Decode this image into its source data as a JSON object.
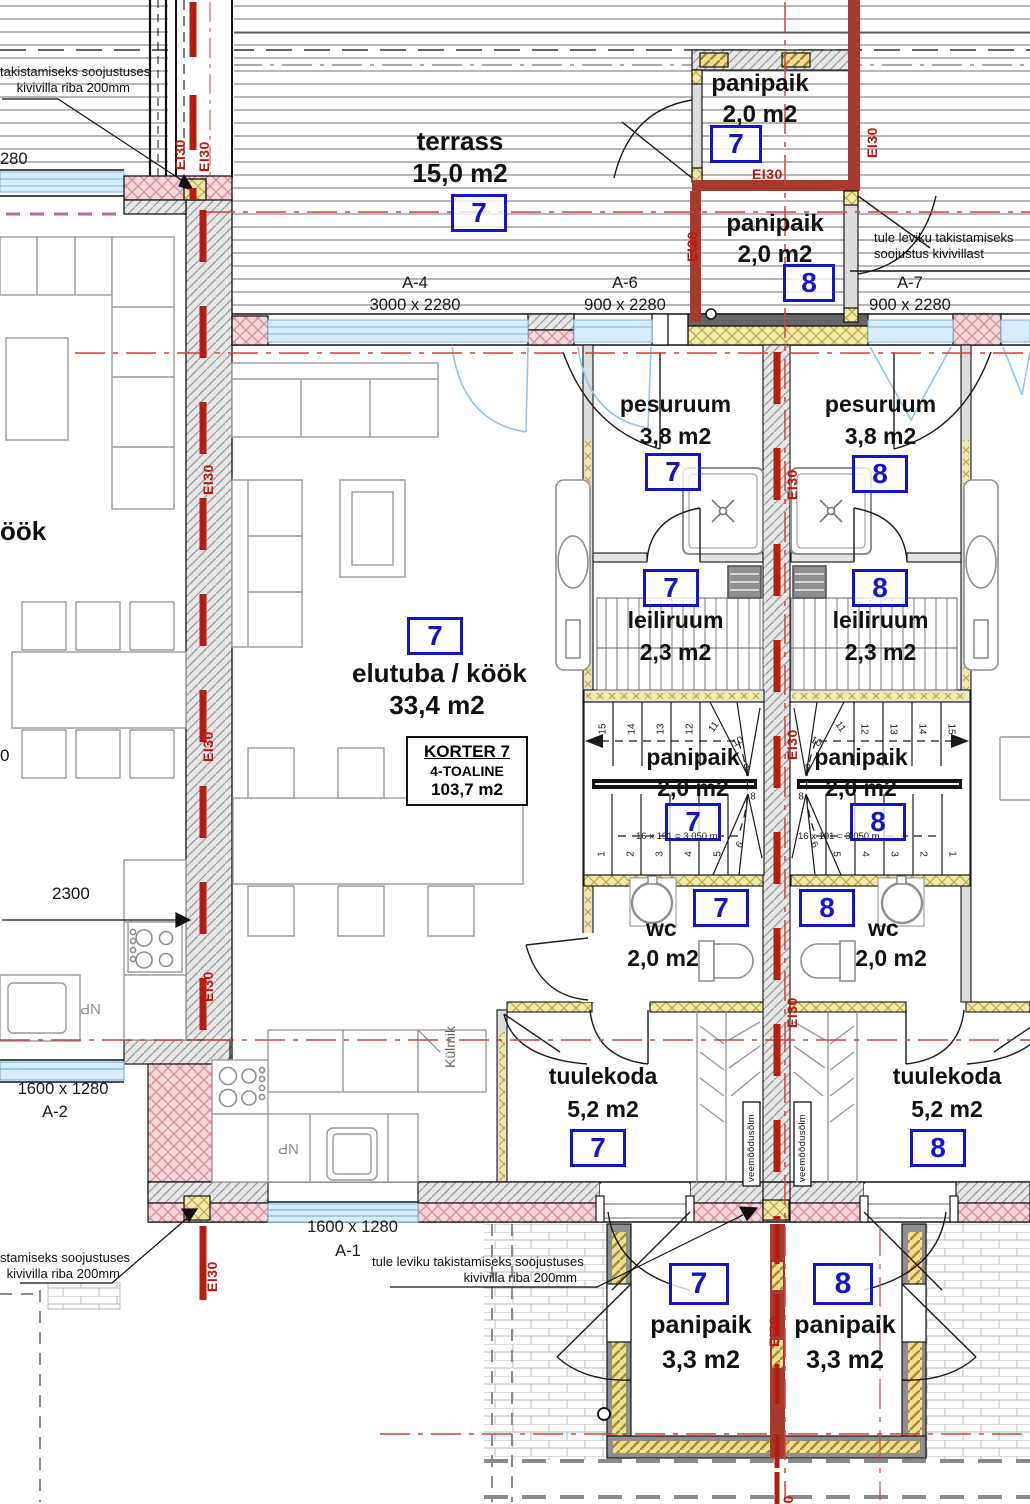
{
  "units": {
    "u7": "7",
    "u8": "8"
  },
  "labels": {
    "terrass": {
      "name": "terrass",
      "area": "15,0 m2"
    },
    "panipaik_t7": {
      "name": "panipaik",
      "area": "2,0 m2"
    },
    "panipaik_t8": {
      "name": "panipaik",
      "area": "2,0 m2"
    },
    "pesuruum7": {
      "name": "pesuruum",
      "area": "3,8 m2"
    },
    "pesuruum8": {
      "name": "pesuruum",
      "area": "3,8 m2"
    },
    "leiliruum7": {
      "name": "leiliruum",
      "area": "2,3 m2"
    },
    "leiliruum8": {
      "name": "leiliruum",
      "area": "2,3 m2"
    },
    "elutuba": {
      "name": "elutuba / köök",
      "area": "33,4 m2"
    },
    "panipaik_s7": {
      "name": "panipaik",
      "area": "2,0 m2"
    },
    "panipaik_s8": {
      "name": "panipaik",
      "area": "2,0 m2"
    },
    "wc7": {
      "name": "wc",
      "area": "2,0 m2"
    },
    "wc8": {
      "name": "wc",
      "area": "2,0 m2"
    },
    "tuulekoda7": {
      "name": "tuulekoda",
      "area": "5,2 m2"
    },
    "tuulekoda8": {
      "name": "tuulekoda",
      "area": "5,2 m2"
    },
    "panipaik_b7": {
      "name": "panipaik",
      "area": "3,3 m2"
    },
    "panipaik_b8": {
      "name": "panipaik",
      "area": "3,3 m2"
    },
    "partial_kook": "öök"
  },
  "korter": {
    "title": "KORTER 7",
    "type": "4-TOALINE",
    "area": "103,7 m2"
  },
  "windows": {
    "a4": {
      "code": "A-4",
      "size": "3000 x 2280"
    },
    "a6": {
      "code": "A-6",
      "size": "900 x 2280"
    },
    "a7": {
      "code": "A-7",
      "size": "900 x 2280"
    },
    "a2": {
      "code": "A-2",
      "size": "1600 x 1280"
    },
    "a1": {
      "code": "A-1",
      "size": "1600 x 1280"
    }
  },
  "notes": {
    "top_left": [
      "takistamiseks soojustuses",
      "kivivilla riba 200mm"
    ],
    "top_right": [
      "tule leviku takistamiseks",
      "soojustus kivivillast"
    ],
    "bottom_left": [
      "stamiseks soojustuses",
      "kivivilla riba 200mm"
    ],
    "bottom_center": [
      "tule leviku takistamiseks soojustuses",
      "kivivilla riba 200mm"
    ]
  },
  "fire": {
    "ei30": "EI30"
  },
  "dims": {
    "d2300": "2300",
    "partial280": "280",
    "partial0": "0"
  },
  "tech": {
    "veemoodusolm": "veemõõdusõlm",
    "np": "NP",
    "kylmik": "Külmik"
  },
  "stairs": {
    "annotation": "16 x 191 = 3,050 m",
    "top": [
      "15",
      "14",
      "13",
      "12",
      "11",
      "10"
    ],
    "bottom": [
      "1",
      "2",
      "3",
      "4",
      "5",
      "6"
    ],
    "mid": [
      "9",
      "8"
    ]
  },
  "colors": {
    "unit_box": "#1315c8",
    "fire_red": "#c0180c",
    "window_blue": "#d8edfb"
  }
}
